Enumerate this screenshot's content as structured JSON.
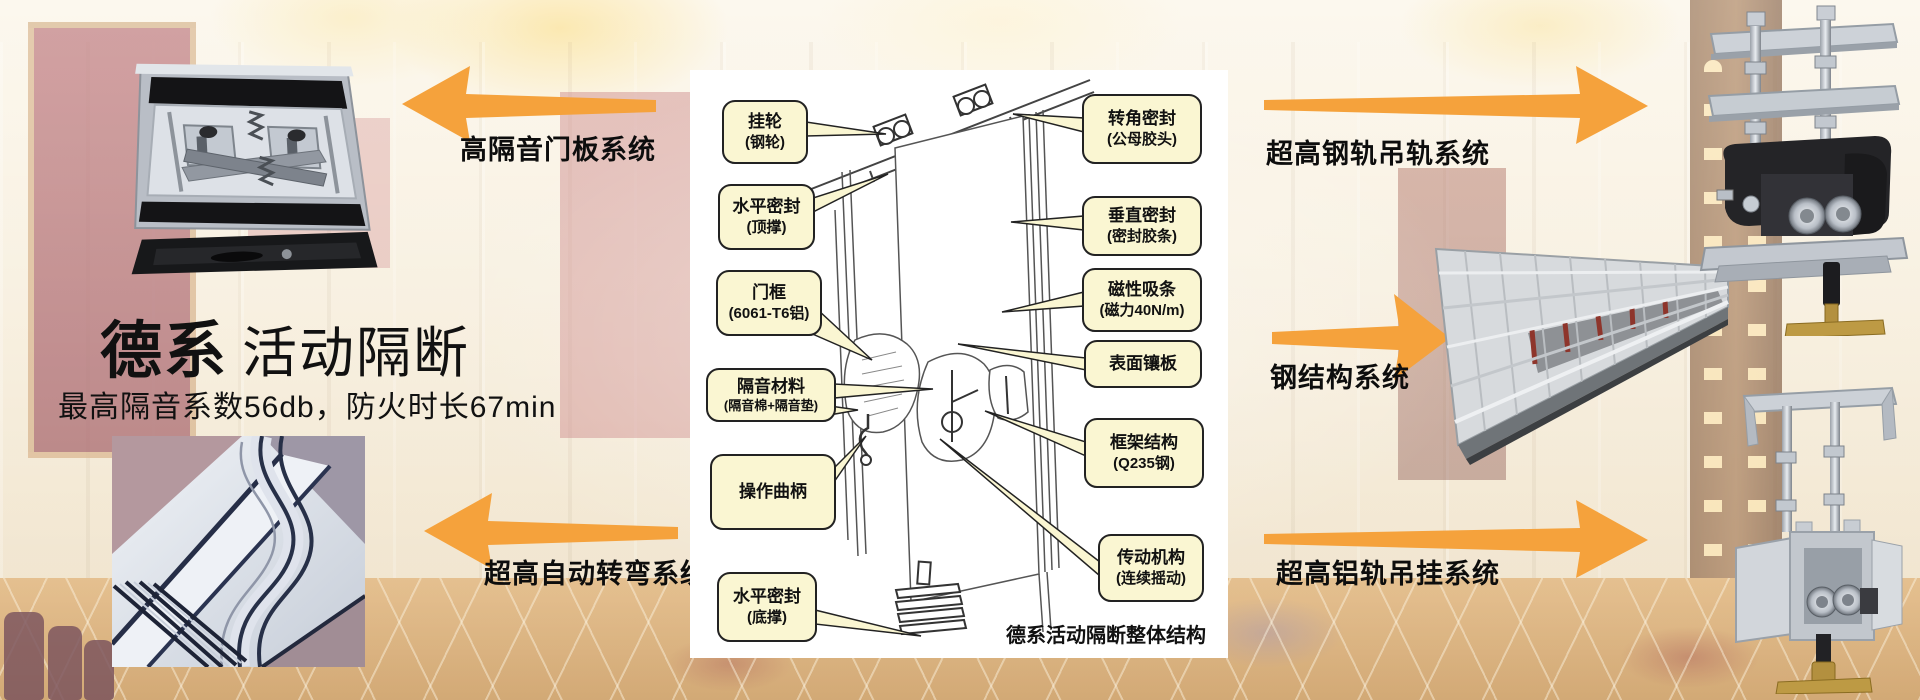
{
  "title": {
    "brand": "德系",
    "name": "活动隔断",
    "subtitle": "最高隔音系数56db，防火时长67min"
  },
  "system_labels": {
    "door_panel": "高隔音门板系统",
    "auto_turning": "超高自动转弯系统",
    "steel_rail_hanging": "超高钢轨吊轨系统",
    "steel_structure": "钢结构系统",
    "aluminum_rail_hanging": "超高铝轨吊挂系统"
  },
  "diagram": {
    "caption": "德系活动隔断整体结构",
    "callouts": [
      {
        "name": "hanging-wheel",
        "line1": "挂轮",
        "line2": "(钢轮)"
      },
      {
        "name": "horizontal-seal-top",
        "line1": "水平密封",
        "line2": "(顶撑)"
      },
      {
        "name": "door-frame",
        "line1": "门框",
        "line2": "(6061-T6铝)"
      },
      {
        "name": "sound-insulation",
        "line1": "隔音材料",
        "line2": "(隔音棉+隔音垫)"
      },
      {
        "name": "operating-crank",
        "line1": "操作曲柄",
        "line2": ""
      },
      {
        "name": "horizontal-seal-bottom",
        "line1": "水平密封",
        "line2": "(底撑)"
      },
      {
        "name": "corner-seal",
        "line1": "转角密封",
        "line2": "(公母胶头)"
      },
      {
        "name": "vertical-seal",
        "line1": "垂直密封",
        "line2": "(密封胶条)"
      },
      {
        "name": "magnetic-strip",
        "line1": "磁性吸条",
        "line2": "(磁力40N/m)"
      },
      {
        "name": "surface-panel",
        "line1": "表面镶板",
        "line2": ""
      },
      {
        "name": "frame-structure",
        "line1": "框架结构",
        "line2": "(Q235钢)"
      },
      {
        "name": "transmission",
        "line1": "传动机构",
        "line2": "(连续摇动)"
      }
    ]
  },
  "colors": {
    "arrow_orange": "#F5A23C",
    "callout_fill": "#FAF6D2",
    "callout_border": "#222222"
  }
}
